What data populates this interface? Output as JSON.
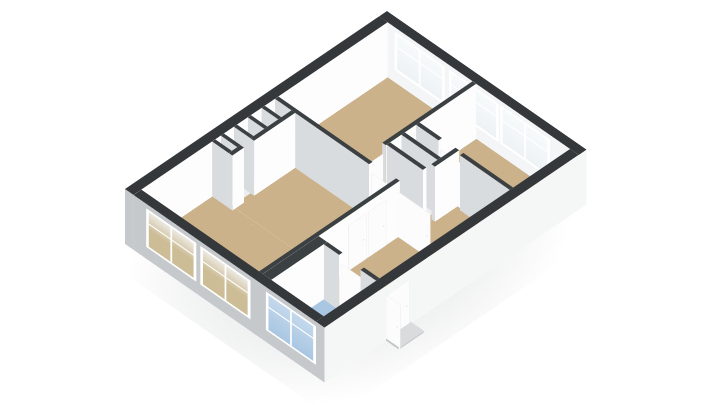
{
  "view": {
    "type": "3d-floor-plan",
    "style": "isometric-render",
    "background": "#ffffff",
    "furniture_shown": false,
    "text_labels_shown": false
  },
  "palette": {
    "background": "#ffffff",
    "shadow": "rgba(120,126,132,0.22)",
    "cap_exterior": "#34383b",
    "cap_interior": "#3b4043",
    "wall_lit": "#fdfdfd",
    "wall_shade": "#d9dcde",
    "wall_outer_shade": "#c6c9cc",
    "wall_outer_front": "#f5f6f6",
    "wall_inner_bright": "#f3f5f6",
    "floor_wood": "#cbb28a",
    "floor_bath": "#a9c6e2",
    "floor_utility": "#eceeef",
    "threshold": "#fbfcfc",
    "frame": "#ffffff",
    "glass_inner": "#edf2f5",
    "glass_see_a": "#cdbd96",
    "glass_see_b": "#ece9e2",
    "glass_bath": "#a9c6e2",
    "door_leaf": "#fcfcfc",
    "door_outline": "#d9dadb",
    "step_top": "#d9dbdd",
    "step_front": "#cbced1",
    "step_side": "#c2c5c8"
  },
  "rooms": [
    {
      "id": "living-room",
      "floor": "floor_wood",
      "windows": 2
    },
    {
      "id": "bedroom-1",
      "floor": "floor_wood",
      "windows": 2
    },
    {
      "id": "bedroom-2",
      "floor": "floor_wood",
      "windows": 1
    },
    {
      "id": "bathroom",
      "floor": "floor_bath",
      "windows": 1
    },
    {
      "id": "hallway",
      "floor": "floor_wood",
      "windows": 0
    },
    {
      "id": "storage",
      "floor": "floor_utility",
      "windows": 0
    },
    {
      "id": "wall-niches",
      "floor": "floor_utility",
      "windows": 0
    }
  ],
  "counts": {
    "windows_total": 6,
    "interior_door_leafs": 6,
    "entrance_steps": 1
  }
}
